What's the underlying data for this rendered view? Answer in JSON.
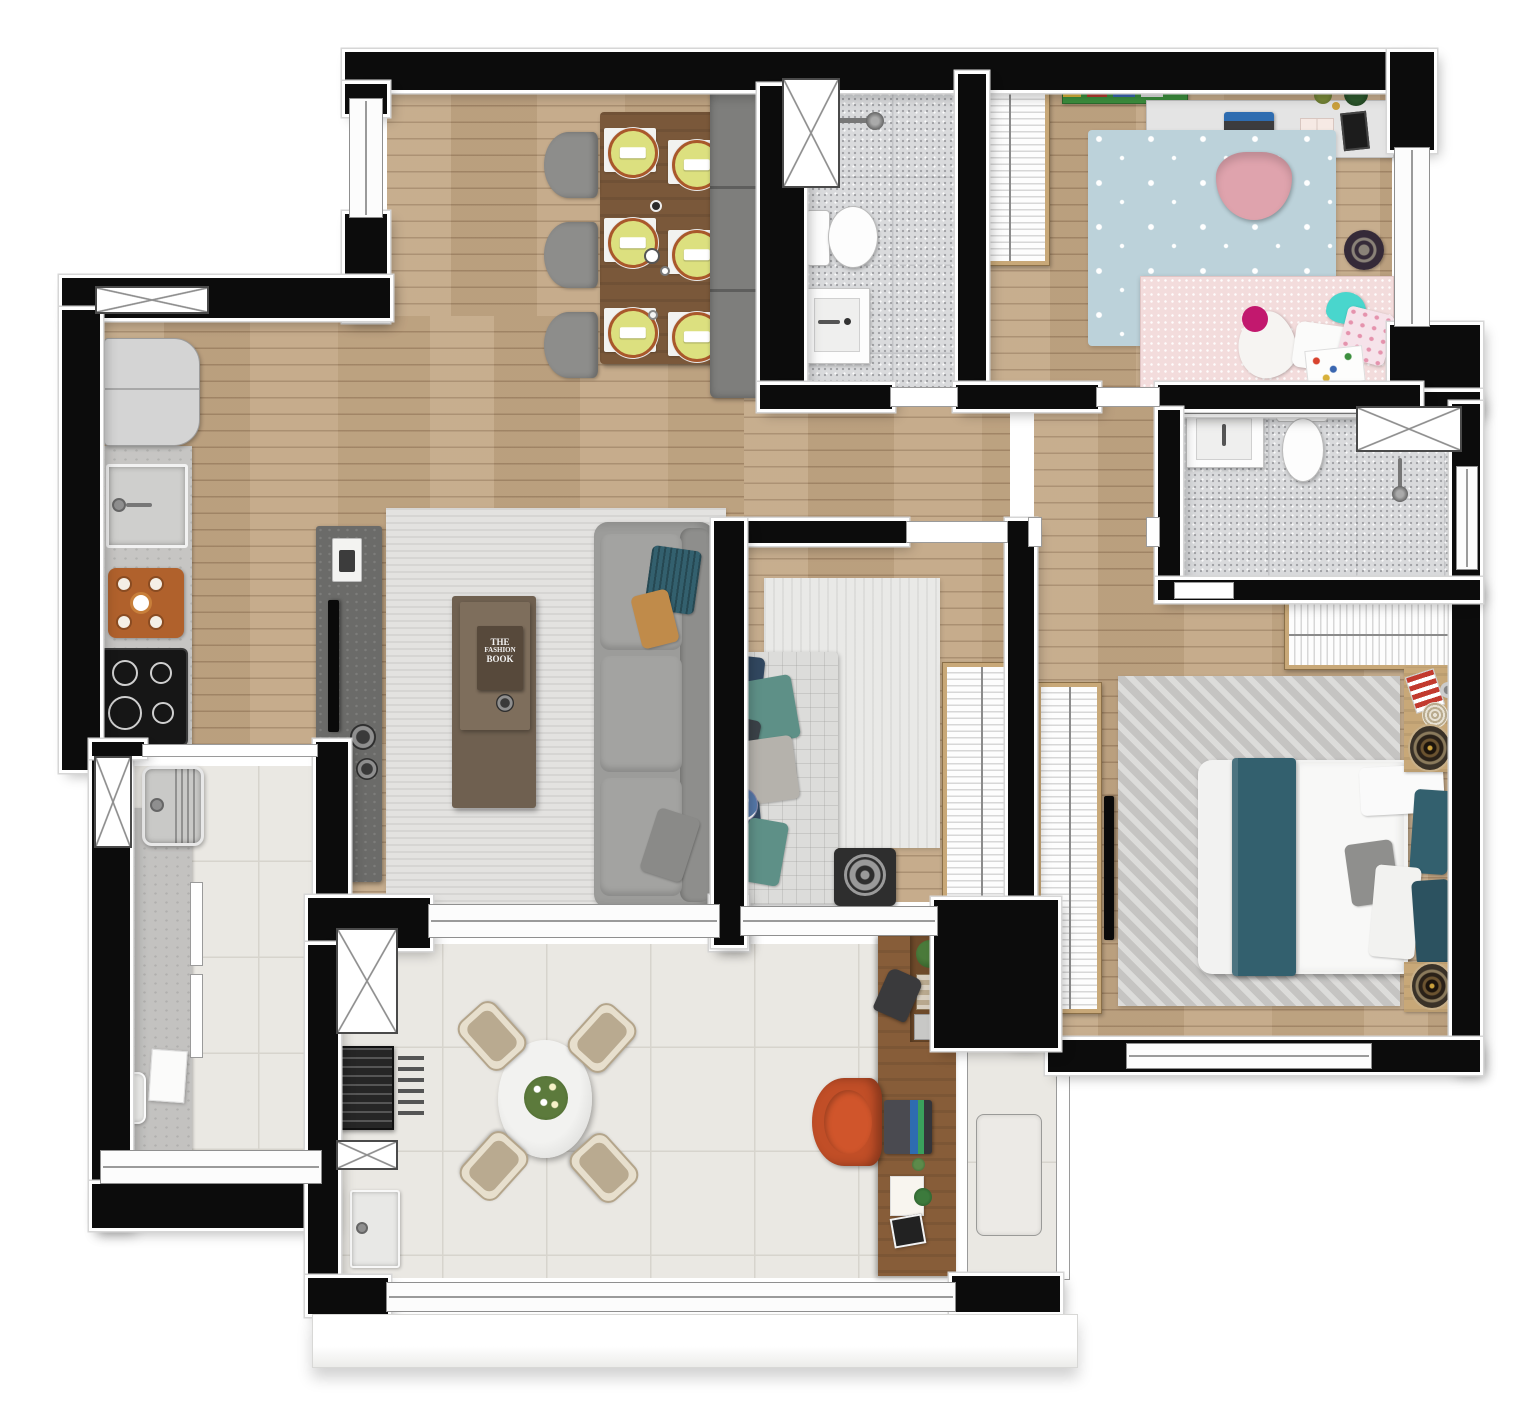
{
  "canvas": {
    "width": 1536,
    "height": 1419
  },
  "palette": {
    "wall": "#0c0c0c",
    "wood": "#c3a886",
    "tile": "#eae8e3",
    "tile_line": "#d7d4cd",
    "bath_tile": "#d9dadc",
    "rug_living": "#e3e2e0",
    "rug_master": "#d1d0ce",
    "kids_rug": "#bcd2da",
    "kids_bed": "#f3dcdc",
    "kids_chair": "#dfa3ad",
    "shelf_green": "#3c8f3e",
    "desk_top": "#e4e4e4",
    "sofa": "#9c9c9a",
    "bench": "#7e7e7c",
    "chair_gray": "#8d8d8b",
    "dining_table": "#7a583a",
    "plate": "#dce07f",
    "plate_rim": "#a9582b",
    "coffee_table": "#6f6050",
    "console": "#6b6b69",
    "wardrobe_wood": "#c8a878",
    "teal": "#33606e",
    "navy": "#31475f",
    "sage": "#5e9087",
    "orange_chair": "#c14e27",
    "terrace_desk": "#875d39",
    "grill": "#262626",
    "counter": "#c6c5c3",
    "fridge": "#d4d4d4",
    "cooktop": "#161616",
    "laundry_counter": "#c3c2c0",
    "bed_duvet": "#f2f2f1"
  },
  "living": {
    "book_lines": [
      "THE",
      "FASHION",
      "BOOK"
    ]
  },
  "rooms": [
    {
      "id": "dining-living",
      "floor": "wood",
      "furniture": [
        "dining-table",
        "six-place-settings",
        "three-chairs",
        "bench",
        "sofa",
        "coffee-table",
        "tv-console",
        "rug"
      ]
    },
    {
      "id": "kitchen",
      "floor": "wood",
      "furniture": [
        "fridge",
        "counter",
        "sink",
        "cutting-board",
        "cooktop"
      ]
    },
    {
      "id": "bathroom-1",
      "floor": "gray-tile",
      "furniture": [
        "shower",
        "toilet",
        "vanity-sink"
      ]
    },
    {
      "id": "kids-room",
      "floor": "wood",
      "furniture": [
        "wardrobe",
        "shelf",
        "desk",
        "laptop",
        "desk-chair",
        "star-rug",
        "bed",
        "plush-toys",
        "wheel-toy"
      ]
    },
    {
      "id": "middle-bedroom",
      "floor": "wood",
      "furniture": [
        "daybed",
        "pillows",
        "rug",
        "pouf",
        "wardrobe"
      ]
    },
    {
      "id": "master-suite",
      "floor": "wood",
      "furniture": [
        "wardrobe-top",
        "wardrobe-side",
        "wall-tv",
        "rug",
        "double-bed",
        "nightstands",
        "speakers"
      ]
    },
    {
      "id": "suite-bathroom",
      "floor": "gray-tile",
      "furniture": [
        "vanity-sink",
        "toilet",
        "shower"
      ]
    },
    {
      "id": "terrace",
      "floor": "large-tile",
      "furniture": [
        "round-table",
        "four-chairs",
        "grill",
        "grill-tools",
        "terrace-sink",
        "desk",
        "office-chair",
        "laptop"
      ]
    },
    {
      "id": "laundry",
      "floor": "large-tile",
      "furniture": [
        "wash-tank",
        "counter",
        "cabinet-doors",
        "towel",
        "tray"
      ]
    },
    {
      "id": "ac-ledge",
      "floor": "tile",
      "furniture": [
        "ac-condenser-unit"
      ]
    }
  ]
}
